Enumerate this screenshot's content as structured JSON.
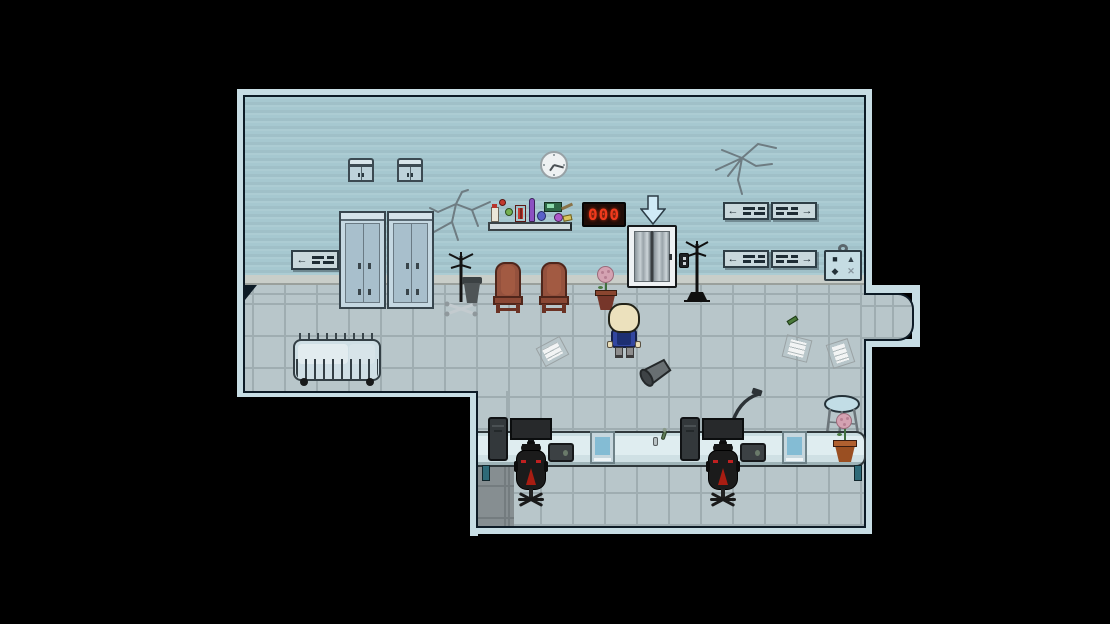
{
  "scene": {
    "type": "top-down pixel RPG room",
    "background": "#000000"
  },
  "room": {
    "wall_color": "#a6c8d0",
    "floor_color": "#b8c6ca",
    "grout_color": "#9fadb1",
    "border_color": "#c7dde4",
    "outline_color": "#0d1b26",
    "baseboard_color": "#c9cec9",
    "dark_floor_patch": "#868e91"
  },
  "elevator": {
    "display_value": "000",
    "display_color": "#f03a1d",
    "arrow_direction": "down"
  },
  "wall_clock": {
    "time": "7:20"
  },
  "signs": {
    "west_wall": {
      "arrow": "←"
    },
    "east_upper_left": {
      "arrow": "←"
    },
    "east_upper_right": {
      "arrow": "→"
    },
    "east_lower_left": {
      "arrow": "←"
    },
    "east_lower_right": {
      "arrow": "→"
    }
  },
  "symbol_board": {
    "symbols": [
      "■",
      "▲",
      "◆",
      "✕"
    ]
  },
  "objects": [
    "wall cabinet x2",
    "storage locker x2",
    "directional sign x5",
    "wall crack x2",
    "lab shelf with bottles flasks vial device",
    "wall clock",
    "floor number display",
    "elevator with call button",
    "down arrow marker",
    "coat stand x2",
    "trash bin",
    "waiting chair x2",
    "potted flower x2",
    "wheeled crib bench",
    "scattered paper x3",
    "green pen",
    "player character",
    "tipped trash can",
    "long office desk",
    "pc tower x2",
    "monitor x2",
    "laptop x2",
    "gaming chair x2",
    "desk lamp",
    "document stack x2",
    "stool",
    "symbol plaque"
  ]
}
